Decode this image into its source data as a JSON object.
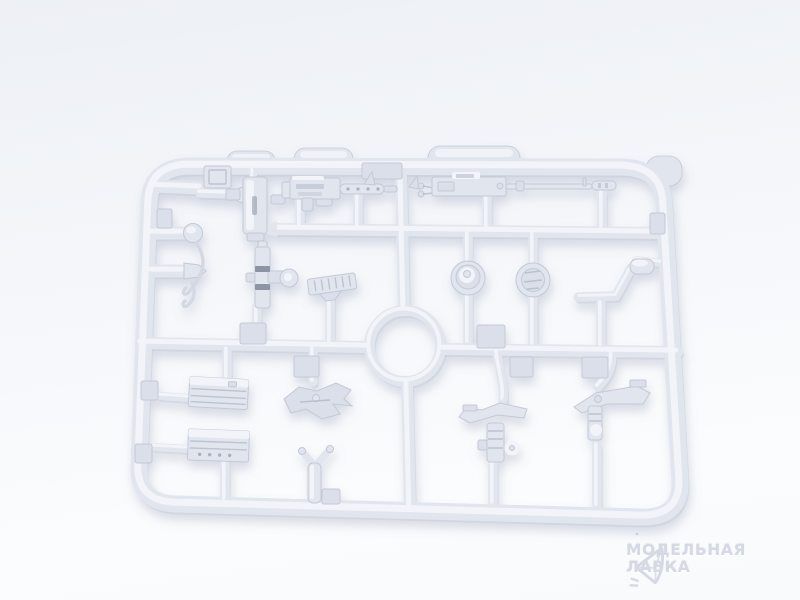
{
  "scene": {
    "type": "product-photo",
    "subject": "Light grey injection-molded plastic model sprue with tank accessory parts on a white studio background",
    "plastic_color_name": "light grey",
    "parts_visible": [
      "sprue-frame",
      "center-runner-ring",
      "machine-gun-short",
      "machine-gun-long-barrel",
      "periscope-housing",
      "corner-bracket",
      "barrel-stub-round-cap",
      "barrel-stub-pointed",
      "wire-hook",
      "gun-cradle-post",
      "ribbed-step-plate",
      "round-hatch-dome",
      "cupola-ring",
      "crank-handle",
      "ammo-box-1",
      "ammo-box-2",
      "mount-plate",
      "y-bracket",
      "pintle-mount-1",
      "pintle-mount-2",
      "blank-pads"
    ]
  },
  "watermark": {
    "icon": "gem-logo-icon",
    "line1": "МОДЕЛЬНАЯ",
    "line2": "ЛАВКА"
  },
  "colors": {
    "bg_top": "#edf0f5",
    "bg_mid": "#f4f6fa",
    "bg_bottom": "#fbfcfd",
    "plastic_base": "#e1e5ee",
    "plastic_light": "#f2f4f9",
    "plastic_mid": "#dadfe9",
    "plastic_shadow": "#c3c9d6",
    "plastic_dark": "#a9b0c0",
    "recess_dark": "#8d94a4",
    "watermark_text": "#ced4e0"
  }
}
